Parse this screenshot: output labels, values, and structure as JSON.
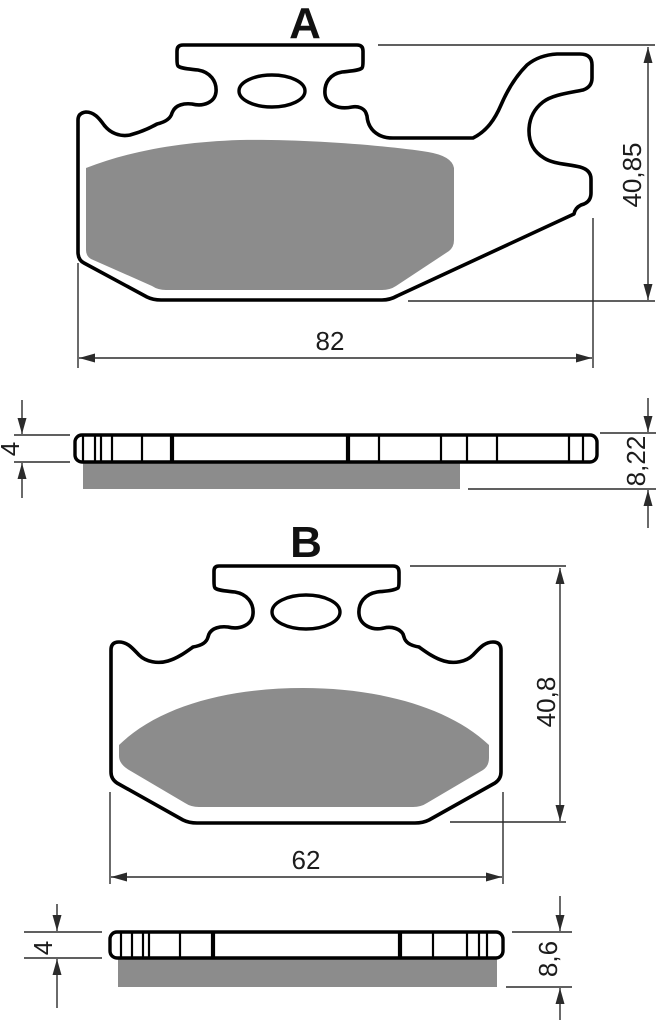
{
  "diagram": {
    "views": [
      {
        "label": "A",
        "width": "82",
        "height": "40,85",
        "side": {
          "plate": "4",
          "total": "8,22"
        }
      },
      {
        "label": "B",
        "width": "62",
        "height": "40,8",
        "side": {
          "plate": "4",
          "total": "8,6"
        }
      }
    ],
    "colors": {
      "background": "#ffffff",
      "outline": "#000000",
      "dimension_lines": "#2b2b2b",
      "friction_material": "#8c8c8c"
    }
  }
}
